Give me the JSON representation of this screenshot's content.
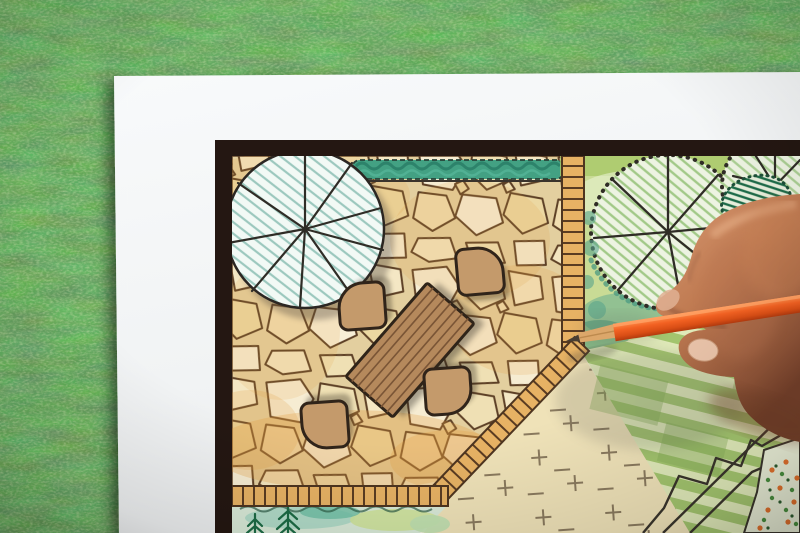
{
  "scene": {
    "type": "photograph",
    "subject": "Hand of a designer drawing a backyard garden landscape plan with an orange colored pencil, paper lying on green lawn grass",
    "environment": {
      "surface": "lawn grass",
      "grass_color": "#41682f"
    },
    "paper": {
      "color": "#f6f8f9",
      "plan_border_color": "#241712",
      "plan_paper_color": "#f7f1dd"
    },
    "plan": {
      "patio": {
        "label": "flagstone patio",
        "stone_fill": "#f3e7c6",
        "stone_outline": "#5d4026",
        "wash_tint": "#e39b3c"
      },
      "hedge": {
        "label": "hedge strip",
        "color": "#43a183"
      },
      "patio_tree": {
        "label": "round canopy tree over patio",
        "fill": "#f2f9f5",
        "hatch": "#7fb8ac",
        "outline": "#2b2622"
      },
      "table": {
        "label": "rectangular wooden garden table",
        "color": "#b5895c",
        "outline": "#2f2419",
        "plank_line": "#7a5536"
      },
      "chairs": {
        "label": "patio chairs",
        "count": 4,
        "color": "#c49a6b",
        "outline": "#30241a"
      },
      "paths": {
        "label": "brick edging paths",
        "brick_color": "#e7b264",
        "joint_color": "#5a3c22"
      },
      "lawn_plus": {
        "label": "lawn area with cross marks",
        "color": "#f2e7c2",
        "mark_color": "#8a7a5e"
      },
      "lawn_striped": {
        "label": "striped green lawn band",
        "light": "#e0eab9",
        "dark": "#a3c56e"
      },
      "right_trees": {
        "label": "tree cluster with radial branch symbols",
        "canopy_fill": "#edf3e2",
        "shading": "#c9db95",
        "outline": "#2f2c26"
      },
      "shrub": {
        "label": "dark hatched evergreen shrub",
        "color": "#1d6b48"
      },
      "planting_bed": {
        "label": "planting bed with ferns",
        "fern_color": "#1c6b45",
        "wash": "#a9d8c6"
      },
      "flower_bed": {
        "label": "dotted flower bed",
        "flower_color": "#e0702c",
        "leaf_color": "#4a8f3f"
      }
    },
    "hand": {
      "label": "right hand holding pencil",
      "skin_light": "#d89a74",
      "skin_dark": "#8f5438",
      "nail": "#e8c2a8"
    },
    "pencil": {
      "label": "orange colored pencil",
      "body": "#f26122",
      "highlight": "#ff9350",
      "wood": "#dca76a",
      "lead": "#4a3f33"
    }
  }
}
